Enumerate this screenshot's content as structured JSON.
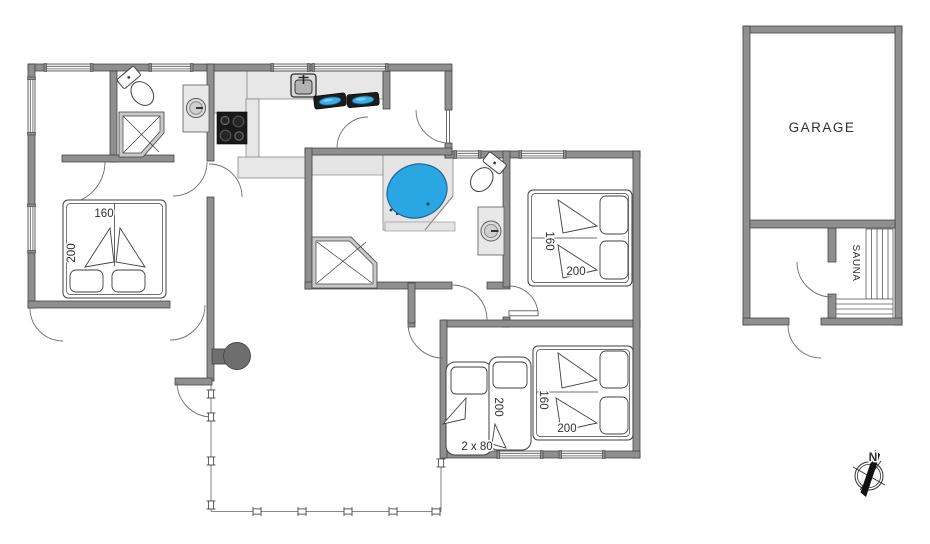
{
  "plan": {
    "rooms": {
      "garage_label": "GARAGE",
      "sauna_label": "SAUNA"
    },
    "beds": {
      "bedroom1": {
        "width": "160",
        "length": "200"
      },
      "bedroom2": {
        "width": "160",
        "length": "200"
      },
      "bedroom3_double": {
        "width": "160",
        "length": "200"
      },
      "bedroom3_singles": {
        "width": "2 x 80",
        "length": "200"
      }
    },
    "compass": {
      "north_label": "N"
    },
    "colors": {
      "wall": "#8f8f8f",
      "wall_edge": "#3f3f3f",
      "fixture_gray": "#e7e7e7",
      "water_blue": "#2aa7e3",
      "stove_black": "#191919",
      "wood_stove_gray": "#6e6e6e"
    }
  }
}
